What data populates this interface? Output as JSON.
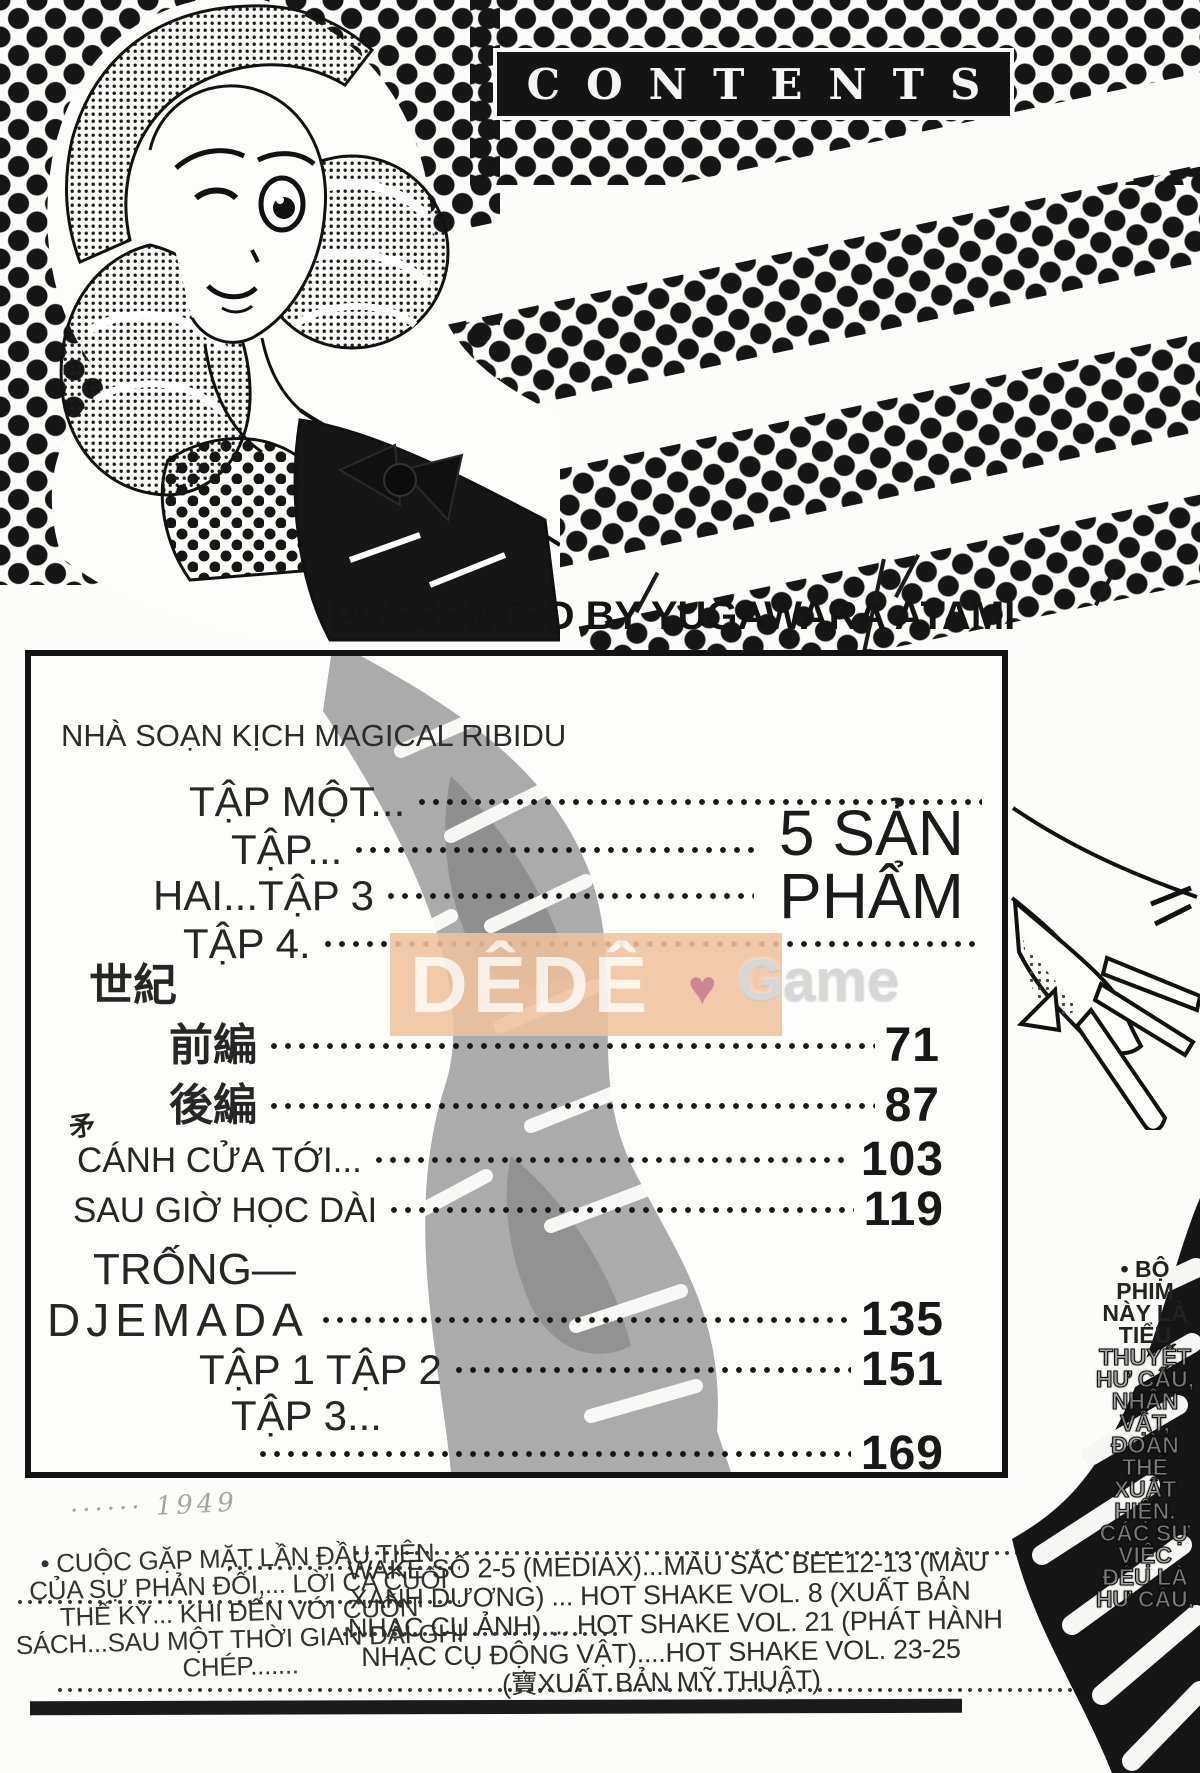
{
  "header": {
    "contents_title": "CONTENTS",
    "presented_by": "PRESENTED BY YUGAWARA ATAMI"
  },
  "toc": {
    "subtitle": "NHÀ SOẠN KỊCH MAGICAL RIBIDU",
    "big_label": "5 SẢN PHẨM",
    "artifact_mark": "矛",
    "entries": [
      {
        "label": "TẬP MỘT...",
        "page": ""
      },
      {
        "label": "TẬP...",
        "page": ""
      },
      {
        "label": "HAI...TẬP 3",
        "page": ""
      },
      {
        "label": "TẬP 4.",
        "page": ""
      },
      {
        "label": "世紀",
        "page": ""
      },
      {
        "label": "前編",
        "page": "71"
      },
      {
        "label": "後編",
        "page": "87"
      },
      {
        "label": "CÁNH CỬA TỚI...",
        "page": "103"
      },
      {
        "label": "SAU GIỜ HỌC DÀI",
        "page": "119"
      },
      {
        "label": "TRỐNG—",
        "page": ""
      },
      {
        "label": "DJEMADA",
        "page": "135"
      },
      {
        "label": "TẬP 1 TẬP 2",
        "page": "151"
      },
      {
        "label": "TẬP 3...",
        "page": ""
      },
      {
        "label": "",
        "page": "169"
      }
    ]
  },
  "watermark": {
    "left": "DÊDÊ",
    "heart": "♥",
    "right": "Game",
    "bg_color": "#f1c29c",
    "heart_color": "#c9808e"
  },
  "side_note": {
    "lines": [
      "• BỘ",
      "PHIM",
      "NÀY LÀ",
      "TIỂU",
      "THUYẾT",
      "HƯ CẤU,",
      "NHÂN",
      "VẬT,",
      "ĐOÀN",
      "THỂ",
      "XUẤT",
      "HIỆN.",
      "CÁC SỰ",
      "VIỆC",
      "ĐỀU LÀ",
      "HƯ CẤU."
    ]
  },
  "footer": {
    "scribble": "······  1949",
    "left_lines": [
      "• CUỘC GẶP MẶT LẦN ĐẦU TIÊN",
      "CỦA SỰ PHẢN ĐỐI,... LỜI CA CUỐI",
      "THẾ KỶ... KHI ĐẾN VỚI CUỐN",
      "SÁCH...SAU MỘT THỜI GIAN DÀI GHI",
      "CHÉP......."
    ],
    "right_lines": [
      "WAKE SỐ 2-5 (MEDIAX)...MÀU SẮC BEE12-13 (MÀU",
      "XANH DƯƠNG) ... HOT SHAKE VOL. 8 (XUẤT BẢN",
      "NHẠC CỤ ẢNH) ... HOT SHAKE VOL. 21 (PHÁT HÀNH",
      "NHẠC CỤ ĐỘNG VẬT)....HOT SHAKE VOL. 23-25",
      "(寶XUẤT BẢN MỸ THUẬT)"
    ]
  }
}
